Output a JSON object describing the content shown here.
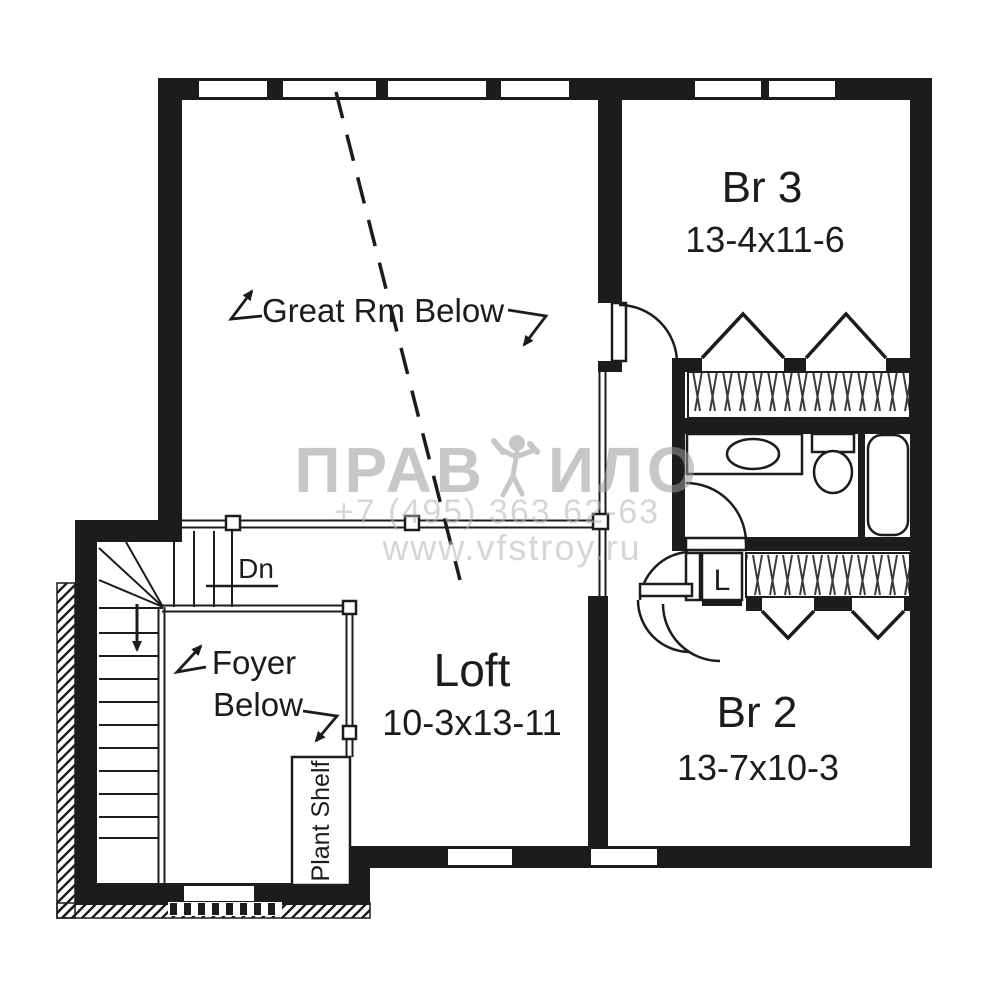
{
  "plan": {
    "rooms": {
      "br3": {
        "label": "Br 3",
        "dims": "13-4x11-6"
      },
      "br2": {
        "label": "Br 2",
        "dims": "13-7x10-3"
      },
      "loft": {
        "label": "Loft",
        "dims": "10-3x13-11"
      },
      "great_rm": {
        "label": "Great Rm Below"
      },
      "foyer": {
        "label_line1": "Foyer",
        "label_line2": "Below"
      },
      "plant_shelf": {
        "label": "Plant Shelf"
      },
      "linen_closet": {
        "label": "L"
      }
    },
    "stairs": {
      "direction_label": "Dn"
    }
  },
  "watermark": {
    "brand_left": "ПРАВ",
    "brand_right": "ИЛО",
    "phone": "+7 (495) 363 62-63",
    "website": "www.vfstroy.ru"
  },
  "colors": {
    "line": "#1c1c1c",
    "background": "#ffffff",
    "watermark_brand": "#9b9b9b",
    "watermark_text": "#b5b5b5"
  }
}
